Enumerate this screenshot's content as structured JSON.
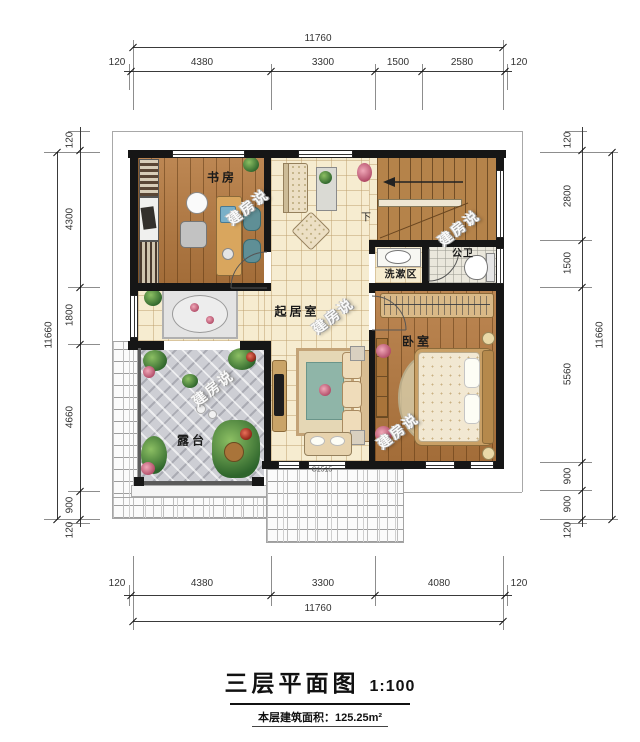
{
  "title": {
    "name": "三层平面图",
    "scale": "1:100",
    "area_note": "本层建筑面积：125.25m²"
  },
  "rooms": {
    "study": "书房",
    "living": "起居室",
    "wash_area": "洗漱区",
    "bathroom": "公卫",
    "bedroom": "卧室",
    "terrace": "露台"
  },
  "stairs": {
    "down_label": "下"
  },
  "window_code": "C1515",
  "watermark": "建房说",
  "dimensions": {
    "top": {
      "total": "11760",
      "segments": [
        "120",
        "4380",
        "3300",
        "1500",
        "2580",
        "120"
      ]
    },
    "bottom": {
      "total": "11760",
      "segments": [
        "120",
        "4380",
        "3300",
        "4080",
        "120"
      ]
    },
    "left": {
      "total": "11660",
      "segments": [
        "120",
        "4300",
        "1800",
        "4660",
        "900",
        "120"
      ]
    },
    "right": {
      "total": "11660",
      "segments": [
        "120",
        "2800",
        "1500",
        "5560",
        "900",
        "900",
        "120"
      ]
    }
  },
  "colors": {
    "wall": "#161616",
    "wood_floor": "#b5793f",
    "tile_floor": "#f6ecd0",
    "terrace_tile": "#cdced4",
    "accent_teal": "#5f8f96"
  }
}
